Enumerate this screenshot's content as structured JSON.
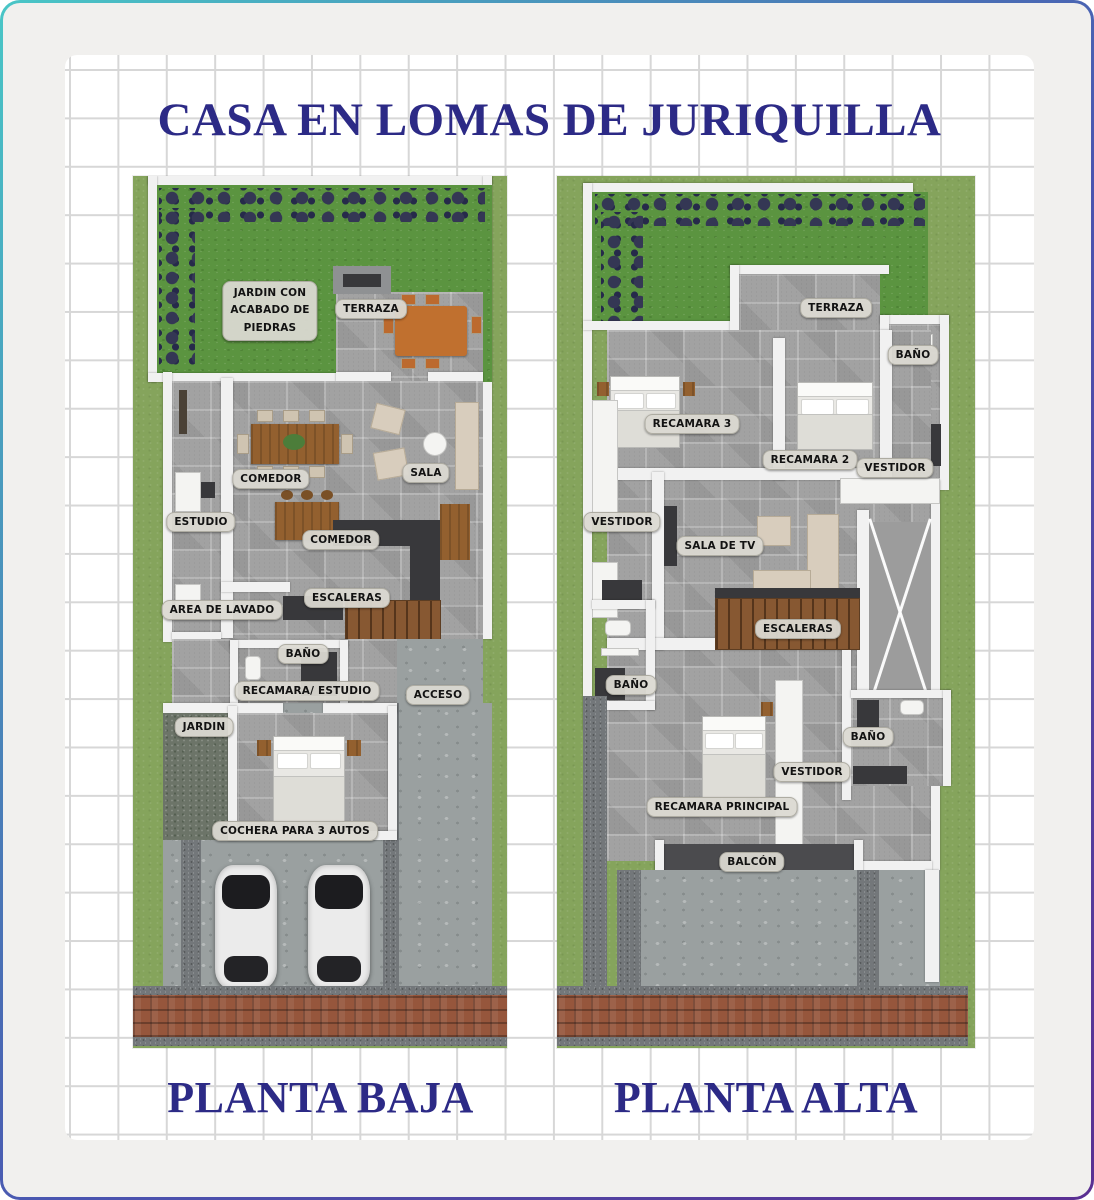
{
  "title": "CASA EN LOMAS DE JURIQUILLA",
  "colors": {
    "heading_navy": "#2c2a86",
    "pill_background": "#dbd9d1",
    "lot_grass": "#85a45c",
    "garden_green": "#5b9440",
    "tile_gray": "#a2a2a2",
    "brick_red": "#96563c",
    "wall_white": "#f1f1f1"
  },
  "planta_baja": {
    "name": "PLANTA BAJA",
    "labels": {
      "jardin_piedras": "JARDIN CON\nACABADO DE\nPIEDRAS",
      "terraza": "TERRAZA",
      "comedor_1": "COMEDOR",
      "sala": "SALA",
      "estudio": "ESTUDIO",
      "comedor_2": "COMEDOR",
      "escaleras": "ESCALERAS",
      "area_lavado": "AREA DE LAVADO",
      "bano": "BAÑO",
      "recamara_estudio": "RECAMARA/ ESTUDIO",
      "acceso": "ACCESO",
      "jardin": "JARDIN",
      "cochera": "COCHERA PARA 3 AUTOS"
    }
  },
  "planta_alta": {
    "name": "PLANTA ALTA",
    "labels": {
      "terraza": "TERRAZA",
      "bano_terraza": "BAÑO",
      "recamara_3": "RECAMARA 3",
      "recamara_2": "RECAMARA 2",
      "vestidor_recamara2": "VESTIDOR",
      "vestidor_pasillo": "VESTIDOR",
      "sala_tv": "SALA DE TV",
      "escaleras": "ESCALERAS",
      "bano_pasillo": "BAÑO",
      "bano_principal": "BAÑO",
      "vestidor_principal": "VESTIDOR",
      "recamara_principal": "RECAMARA PRINCIPAL",
      "balcon": "BALCÓN"
    }
  }
}
